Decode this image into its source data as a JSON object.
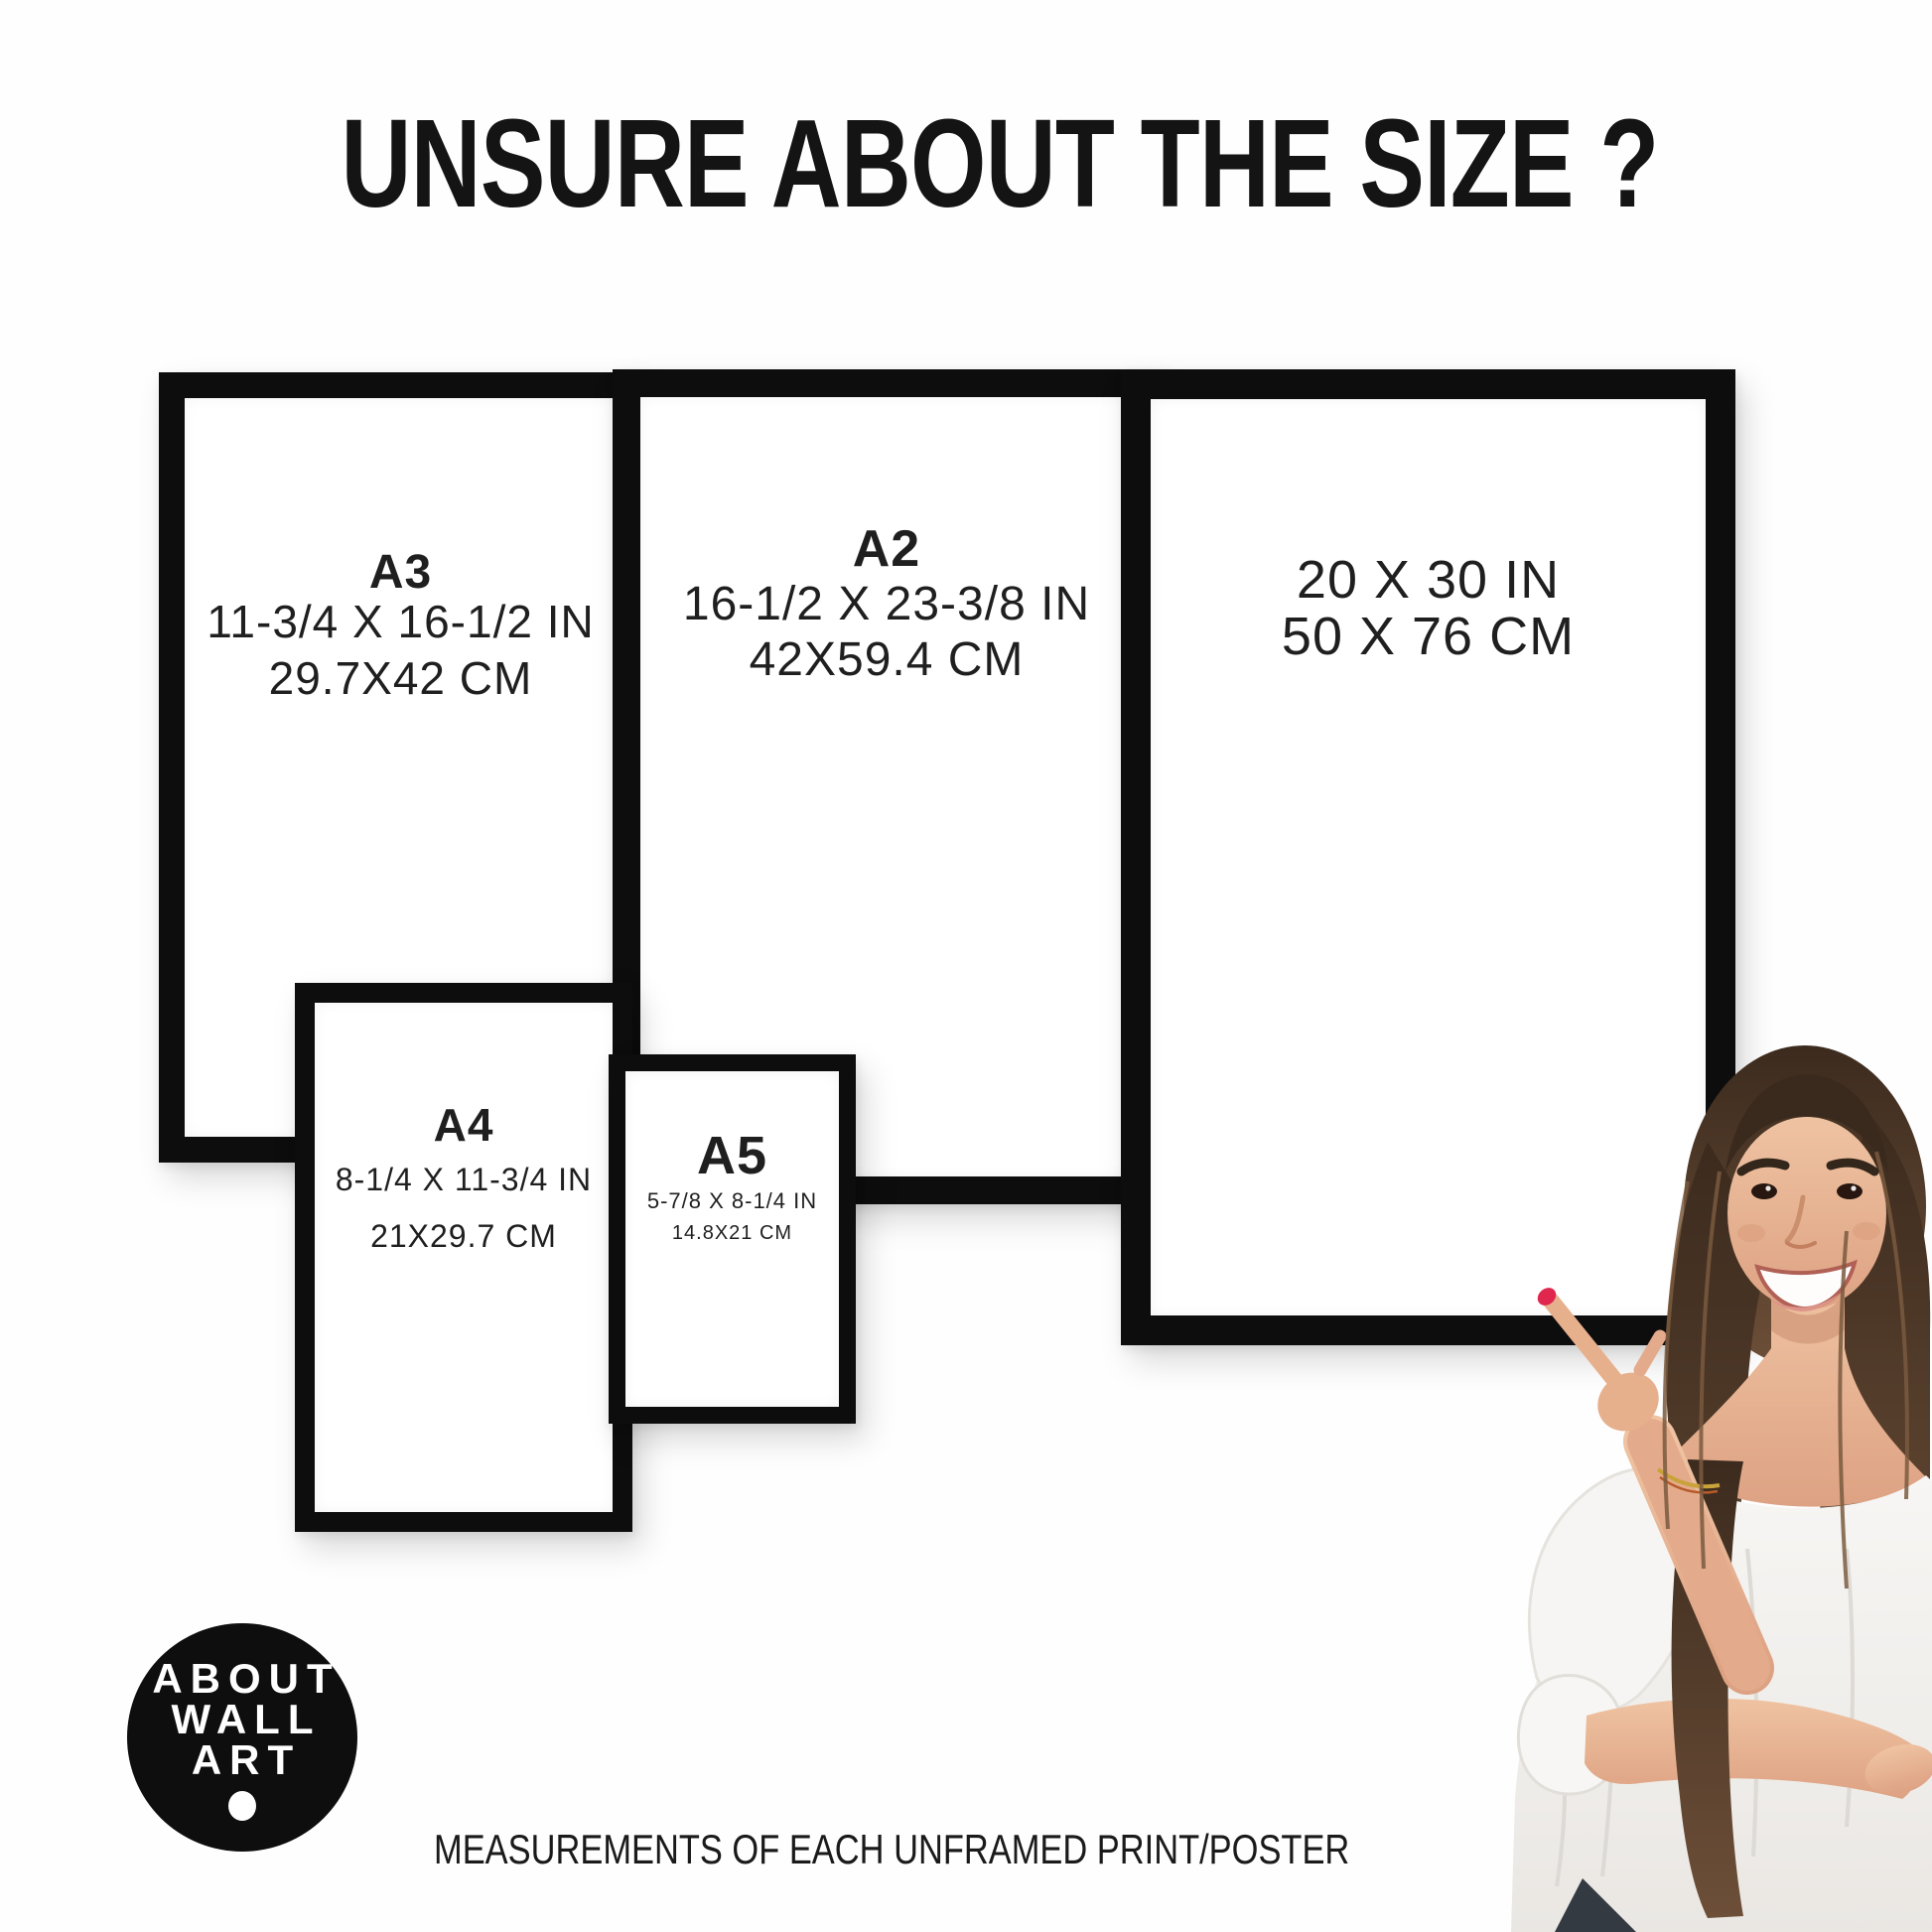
{
  "title": "UNSURE ABOUT THE SIZE ?",
  "frames": [
    {
      "name": "A3",
      "label": "A3",
      "inches": "11-3/4 X 16-1/2 IN",
      "cm": "29.7X42 CM"
    },
    {
      "name": "A2",
      "label": "A2",
      "inches": "16-1/2 X 23-3/8 IN",
      "cm": "42X59.4 CM"
    },
    {
      "name": "20x30",
      "label": "",
      "inches": "20 X 30 IN",
      "cm": "50 X 76 CM"
    },
    {
      "name": "A4",
      "label": "A4",
      "inches": "8-1/4 X 11-3/4 IN",
      "cm": "21X29.7 CM"
    },
    {
      "name": "A5",
      "label": "A5",
      "inches": "5-7/8 X 8-1/4 IN",
      "cm": "14.8X21 CM"
    }
  ],
  "logo": {
    "line1": "ABOUT",
    "line2": "WALL",
    "line3": "ART"
  },
  "footer": "MEASUREMENTS OF EACH UNFRAMED PRINT/POSTER",
  "colors": {
    "frame_border": "#0d0d0d",
    "text": "#1f1f1f",
    "logo_background": "#0e0e0e",
    "logo_text": "#ffffff",
    "nail_polish": "#e0274e",
    "hair": "#4a3526",
    "skin": "#e7b08d",
    "blouse": "#f3f2f0"
  },
  "illustration": {
    "description": "Smiling woman with long brown hair, white off-shoulder top, pointing left with red-polished finger"
  }
}
